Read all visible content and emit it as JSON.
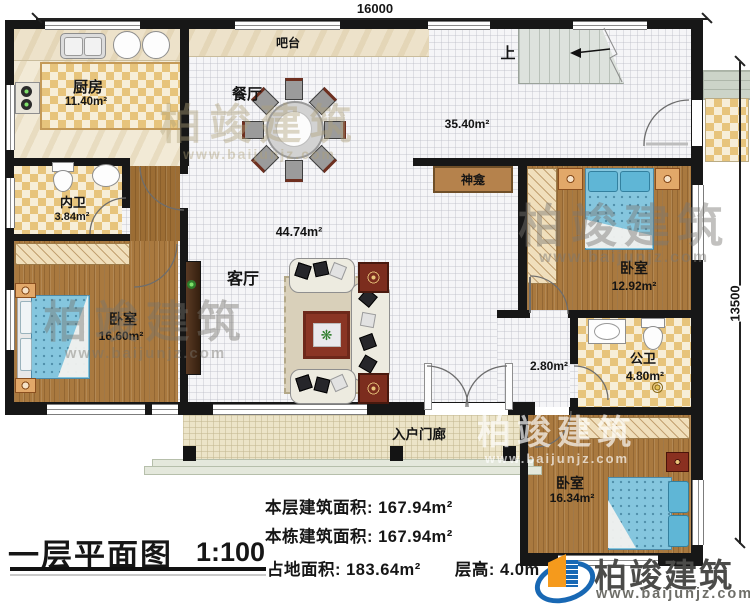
{
  "dims": {
    "top": "16000",
    "right": "13500"
  },
  "rooms": {
    "bar": {
      "name": "吧台"
    },
    "kitchen": {
      "name": "厨房",
      "area": "11.40m²"
    },
    "dining": {
      "name": "餐厅"
    },
    "stairs": {
      "label": "上"
    },
    "hall": {
      "area": "35.40m²"
    },
    "shrine": {
      "name": "神龛"
    },
    "bedroom_right": {
      "name": "卧室",
      "area": "12.92m²"
    },
    "living": {
      "name": "客厅",
      "area": "44.74m²"
    },
    "bath_inner": {
      "name": "内卫",
      "area": "3.84m²"
    },
    "bedroom_left": {
      "name": "卧室",
      "area": "16.60m²"
    },
    "corridor": {
      "area": "2.80m²"
    },
    "bath_public": {
      "name": "公卫",
      "area": "4.80m²"
    },
    "porch": {
      "name": "入户门廊"
    },
    "bedroom_bottom": {
      "name": "卧室",
      "area": "16.34m²"
    }
  },
  "title": {
    "text": "一层平面图",
    "scale": "1:100"
  },
  "stats": {
    "floor_area_label": "本层建筑面积:",
    "floor_area_value": "167.94m²",
    "building_area_label": "本栋建筑面积:",
    "building_area_value": "167.94m²",
    "land_area_label": "占地面积:",
    "land_area_value": "183.64m²",
    "height_label": "层高:",
    "height_value": "4.0m"
  },
  "branding": {
    "name": "柏竣建筑",
    "url": "www.baijunjz.com",
    "blue": "#1868b4",
    "orange": "#f59a1c"
  },
  "watermark": {
    "name": "柏竣建筑",
    "url": "www.baijunjz.com"
  }
}
